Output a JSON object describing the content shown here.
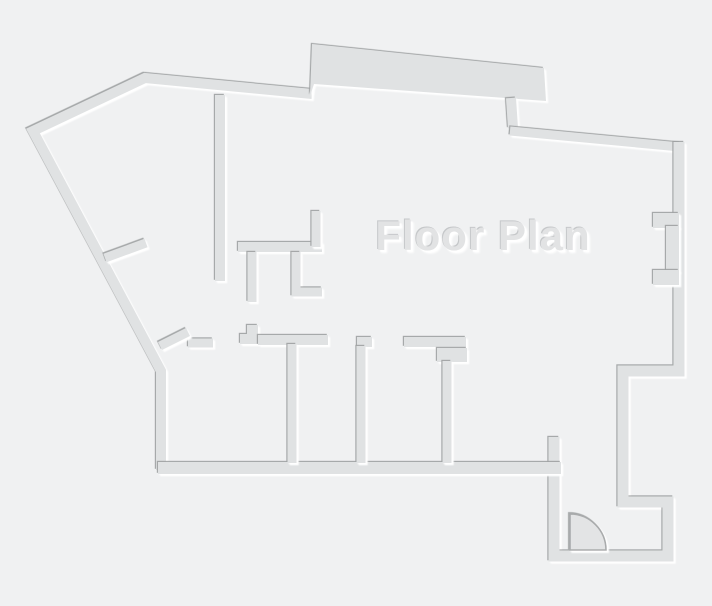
{
  "title": "Floor Plan",
  "canvas": {
    "width": 712,
    "height": 606
  },
  "colors": {
    "background": "#f0f1f2",
    "wall_fill": "#e0e2e3",
    "shadow_dark": "#9fa1a2",
    "highlight_white": "#ffffff",
    "door_fill": "#e3e4e5",
    "door_stroke": "#a9abac",
    "title_fill": "#e2e3e4",
    "title_shadow_dark": "#c5c7c9",
    "title_shadow_light": "#ffffff"
  },
  "title_style": {
    "center_x": 483,
    "center_y": 236,
    "font_size": 42
  },
  "floorplan": {
    "walls": [
      {
        "name": "exterior-west-and-north-wall",
        "type": "polyline",
        "width": 10,
        "points": [
          [
            161,
            470
          ],
          [
            161,
            371
          ],
          [
            33,
            131
          ],
          [
            145,
            78
          ],
          [
            312,
            94
          ]
        ]
      },
      {
        "name": "north-balcony-band",
        "type": "polygon",
        "points": [
          [
            310,
            96
          ],
          [
            312,
            44
          ],
          [
            544,
            68
          ],
          [
            546,
            101
          ],
          [
            314,
            84
          ]
        ]
      },
      {
        "name": "north-jog-wall",
        "type": "polyline",
        "width": 10,
        "points": [
          [
            511,
            98
          ],
          [
            513,
            128
          ]
        ]
      },
      {
        "name": "northeast-diagonal-wall",
        "type": "polyline",
        "width": 9,
        "points": [
          [
            510,
            131
          ],
          [
            680,
            147
          ]
        ]
      },
      {
        "name": "east-and-entry-wall",
        "type": "polyline",
        "width": 11,
        "points": [
          [
            679,
            142
          ],
          [
            679,
            371
          ],
          [
            623,
            371
          ],
          [
            623,
            502
          ],
          [
            668,
            502
          ],
          [
            668,
            556
          ],
          [
            554,
            556
          ],
          [
            554,
            437
          ]
        ]
      },
      {
        "name": "east-wall-upper-jamb",
        "type": "rect",
        "x": 653,
        "y": 213,
        "w": 26,
        "h": 15
      },
      {
        "name": "east-wall-recess",
        "type": "rect",
        "x": 666,
        "y": 226,
        "w": 13,
        "h": 46
      },
      {
        "name": "east-wall-lower-jamb",
        "type": "rect",
        "x": 653,
        "y": 270,
        "w": 26,
        "h": 15
      },
      {
        "name": "rooms-bottom-wall",
        "type": "polyline",
        "width": 12,
        "points": [
          [
            158,
            468
          ],
          [
            561,
            468
          ]
        ]
      },
      {
        "name": "room1-top-wall",
        "type": "polyline",
        "width": 9,
        "points": [
          [
            188,
            343
          ],
          [
            213,
            343
          ]
        ]
      },
      {
        "name": "west-door-leaf-stub",
        "type": "polyline",
        "width": 9,
        "points": [
          [
            160,
            346
          ],
          [
            188,
            332
          ]
        ]
      },
      {
        "name": "step-pier",
        "type": "polygon",
        "points": [
          [
            240,
            344
          ],
          [
            240,
            334
          ],
          [
            247,
            334
          ],
          [
            247,
            325
          ],
          [
            258,
            325
          ],
          [
            258,
            344
          ]
        ]
      },
      {
        "name": "rooms-top-wall-mid",
        "type": "polyline",
        "width": 10,
        "points": [
          [
            258,
            340
          ],
          [
            328,
            340
          ]
        ]
      },
      {
        "name": "partition2-top-tab",
        "type": "polyline",
        "width": 10,
        "points": [
          [
            357,
            342
          ],
          [
            372,
            342
          ]
        ]
      },
      {
        "name": "rooms-top-wall-east",
        "type": "polyline",
        "width": 10,
        "points": [
          [
            404,
            342
          ],
          [
            466,
            342
          ]
        ]
      },
      {
        "name": "partition3-top-tab",
        "type": "rect",
        "x": 437,
        "y": 348,
        "w": 30,
        "h": 14
      },
      {
        "name": "room-partition-1",
        "type": "polyline",
        "width": 9,
        "points": [
          [
            292,
            344
          ],
          [
            292,
            463
          ]
        ]
      },
      {
        "name": "room-partition-2",
        "type": "polyline",
        "width": 9,
        "points": [
          [
            361,
            346
          ],
          [
            361,
            463
          ]
        ]
      },
      {
        "name": "room-partition-3",
        "type": "polyline",
        "width": 9,
        "points": [
          [
            447,
            361
          ],
          [
            447,
            463
          ]
        ]
      },
      {
        "name": "core-north-wall",
        "type": "polyline",
        "width": 10,
        "points": [
          [
            220,
            95
          ],
          [
            220,
            281
          ]
        ]
      },
      {
        "name": "core-mid-horizontal-wall",
        "type": "polyline",
        "width": 10,
        "points": [
          [
            238,
            247
          ],
          [
            322,
            247
          ]
        ]
      },
      {
        "name": "core-mid-vertical-return",
        "type": "polyline",
        "width": 9,
        "points": [
          [
            316,
            211
          ],
          [
            316,
            247
          ]
        ]
      },
      {
        "name": "core-stub-wall",
        "type": "polyline",
        "width": 9,
        "points": [
          [
            252,
            252
          ],
          [
            252,
            302
          ]
        ]
      },
      {
        "name": "core-l-wall",
        "type": "polyline",
        "width": 9,
        "points": [
          [
            296,
            252
          ],
          [
            296,
            292
          ],
          [
            322,
            292
          ]
        ]
      },
      {
        "name": "northwest-door-leaf-stub",
        "type": "polyline",
        "width": 9,
        "points": [
          [
            105,
            258
          ],
          [
            146,
            243
          ]
        ]
      }
    ],
    "entry_door": {
      "swing_path": "M 570,514 A 36,36 0 0 1 606,550 L 570,550 Z"
    }
  }
}
